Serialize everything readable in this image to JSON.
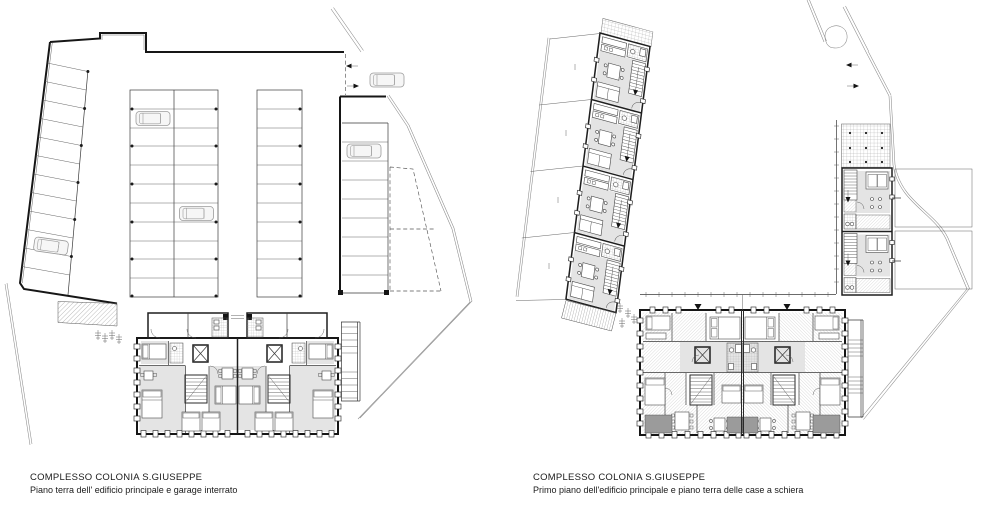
{
  "sheet": {
    "background": "#ffffff",
    "ink": "#1a1a1a",
    "floor_fill": "#e4e4e4",
    "balcony_fill": "#9b9b9b"
  },
  "plans": [
    {
      "id": "ground-floor-and-garage",
      "title": "COMPLESSO COLONIA S.GIUSEPPE",
      "subtitle": "Piano terra dell' edificio principale e garage interrato"
    },
    {
      "id": "first-floor-and-row-houses",
      "title": "COMPLESSO COLONIA S.GIUSEPPE",
      "subtitle": "Primo piano dell'edificio principale e piano terra delle case a schiera"
    }
  ]
}
